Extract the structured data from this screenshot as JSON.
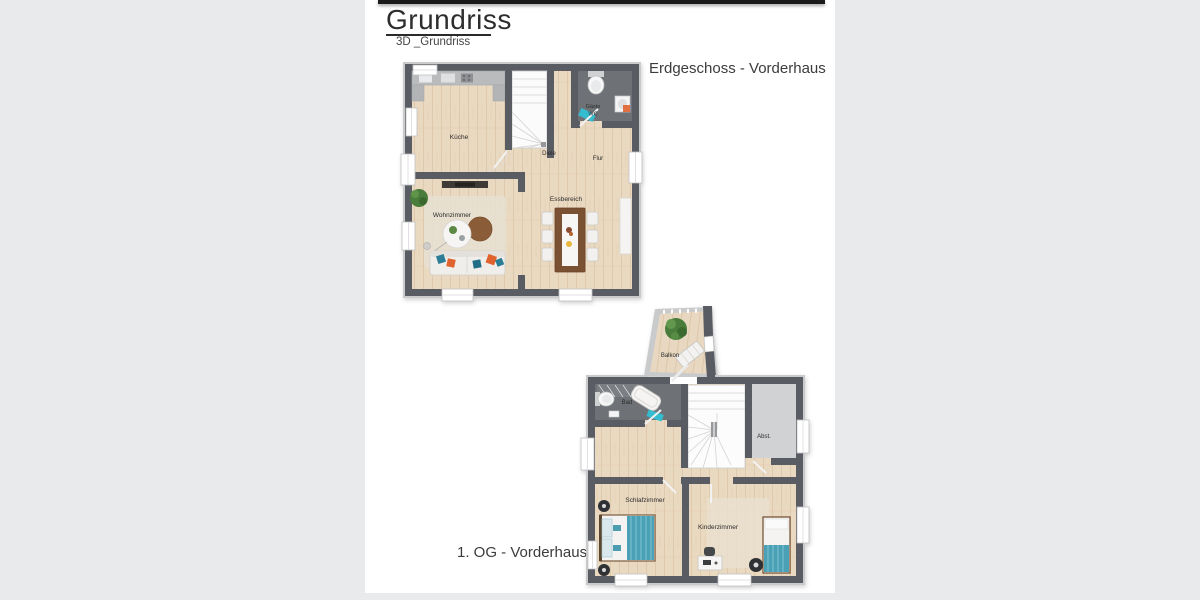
{
  "page": {
    "title": "Grundriss",
    "subtitle": "3D _Grundriss"
  },
  "floorplans": {
    "erdgeschoss": {
      "caption": "Erdgeschoss - Vorderhaus",
      "rooms": {
        "kueche": "Küche",
        "diele": "Diele",
        "gaeste_wc_line1": "Gäste",
        "gaeste_wc_line2": "WC",
        "flur": "Flur",
        "wohnzimmer": "Wohnzimmer",
        "essbereich": "Essbereich"
      }
    },
    "obergeschoss": {
      "caption": "1. OG - Vorderhaus",
      "rooms": {
        "balkon": "Balkon",
        "bad": "Bad",
        "abstellraum": "Abst.",
        "schlafzimmer": "Schlafzimmer",
        "kinderzimmer": "Kinderzimmer"
      }
    }
  },
  "colors": {
    "wall": "#595c62",
    "wall_outline": "#c9cacb",
    "floor_wood": "#ead9c1",
    "floor_tile_dark": "#6e7176",
    "floor_storage": "#d0d2d3",
    "accent_teal": "#35bccf",
    "accent_orange": "#e0632e",
    "pillow_teal": "#2b7e95",
    "bed_teal": "#4aa0b5",
    "table_brown": "#7b5133",
    "plant_green": "#4a7c3c"
  }
}
